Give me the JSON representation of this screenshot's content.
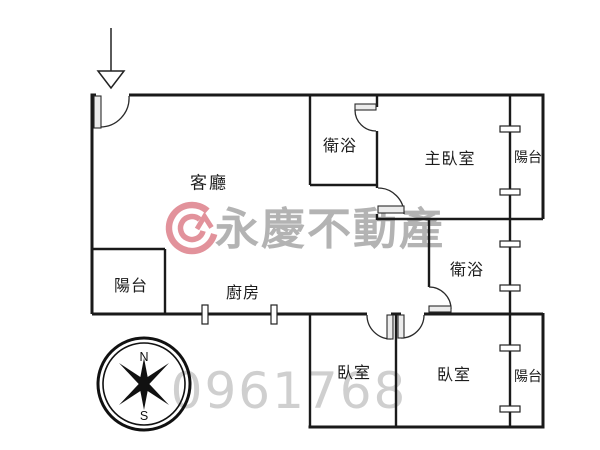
{
  "plan": {
    "rooms": {
      "living": "客廳",
      "bath_top": "衛浴",
      "master": "主臥室",
      "balcony_top_right": "陽台",
      "balcony_left": "陽台",
      "kitchen": "廚房",
      "bath_mid": "衛浴",
      "bedroom_left": "臥室",
      "bedroom_right": "臥室",
      "balcony_bottom_right": "陽台"
    },
    "compass": {
      "north": "N",
      "south": "S"
    }
  },
  "watermark": {
    "brand": "永慶不動產",
    "number": "0961768",
    "brand_color": "#b3b3b3",
    "number_color": "#cfcfcf",
    "logo_color": "#e2929b"
  },
  "colors": {
    "wall": "#1a1a1a",
    "background": "#ffffff"
  }
}
